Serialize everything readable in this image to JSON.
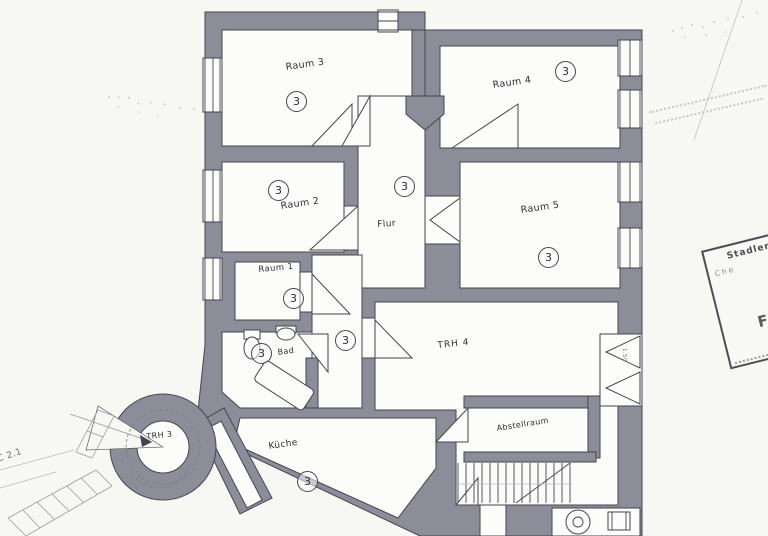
{
  "plan": {
    "rooms": {
      "raum1": "Raum 1",
      "raum2": "Raum 2",
      "raum3": "Raum 3",
      "raum4": "Raum 4",
      "raum5": "Raum 5",
      "flur": "Flur",
      "bad": "Bad",
      "kueche": "Küche",
      "abstellraum": "Abstellraum",
      "trh3": "TRH 3",
      "trh4": "TRH 4"
    },
    "annotations": {
      "left_edge": "C 2.1",
      "door_width": "1.50"
    },
    "unit_markers": [
      "3",
      "3",
      "3",
      "3",
      "3",
      "3",
      "3",
      "3",
      "3"
    ]
  },
  "stamp": {
    "line1": "Stadler",
    "line2": "Che",
    "line3": "7",
    "line4": "FE"
  },
  "colors": {
    "wall": "#8d8d99",
    "line": "#45454d",
    "paper": "#f7f7f4",
    "room": "#fcfcfb"
  }
}
